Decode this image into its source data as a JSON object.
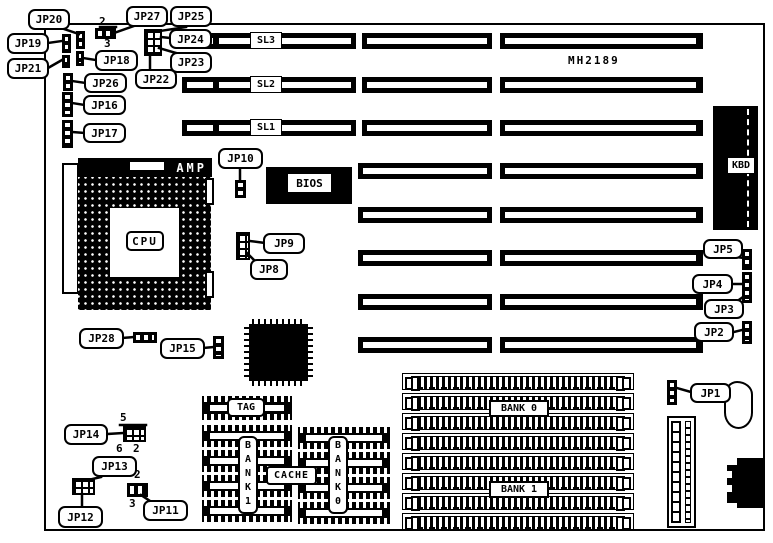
{
  "board": {
    "part_number": "MH2189"
  },
  "slots": {
    "sl1": "SL1",
    "sl2": "SL2",
    "sl3": "SL3"
  },
  "components": {
    "cpu": "CPU",
    "amp": "AMP",
    "bios": "BIOS",
    "kbd": "KBD",
    "tag": "TAG",
    "cache": "CACHE",
    "cache_bank0": "BANK0",
    "cache_bank1": "BANK1",
    "simm_bank0": "BANK 0",
    "simm_bank1": "BANK 1"
  },
  "jumpers": {
    "jp1": "JP1",
    "jp2": "JP2",
    "jp3": "JP3",
    "jp4": "JP4",
    "jp5": "JP5",
    "jp8": "JP8",
    "jp9": "JP9",
    "jp10": "JP10",
    "jp11": "JP11",
    "jp12": "JP12",
    "jp13": "JP13",
    "jp14": "JP14",
    "jp15": "JP15",
    "jp16": "JP16",
    "jp17": "JP17",
    "jp18": "JP18",
    "jp19": "JP19",
    "jp20": "JP20",
    "jp21": "JP21",
    "jp22": "JP22",
    "jp23": "JP23",
    "jp24": "JP24",
    "jp25": "JP25",
    "jp26": "JP26",
    "jp27": "JP27",
    "jp28": "JP28"
  },
  "pin_labels": {
    "jp27_pin2": "2",
    "jp27_pin3": "3",
    "jp14_pin5": "5",
    "jp14_pin6": "6",
    "jp14_pin2": "2",
    "jp11_pin2": "2",
    "jp11_pin3": "3"
  }
}
